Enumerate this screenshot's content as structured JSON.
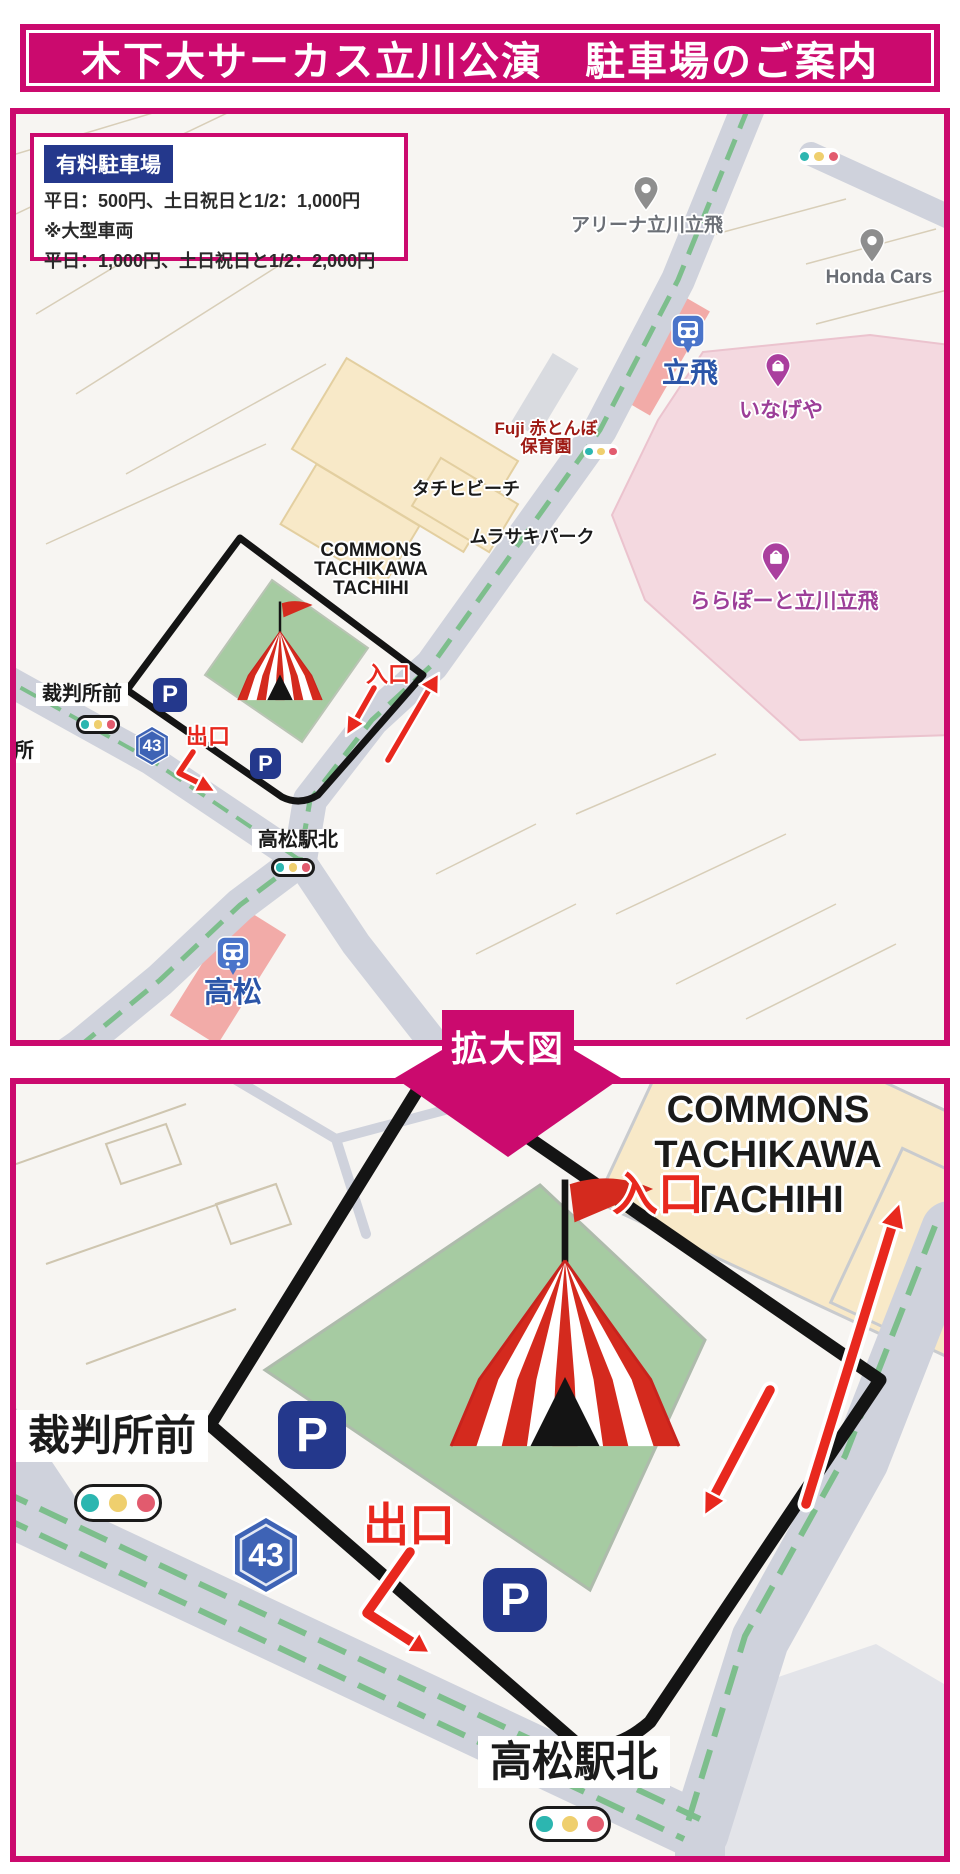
{
  "header": {
    "title": "木下大サーカス立川公演　駐車場のご案内"
  },
  "fee_box": {
    "badge": "有料駐車場",
    "weekday_line": "平日：500円、土日祝日と1/2：1,000円",
    "note": "※大型車両",
    "large_vehicle_line": "平日：1,000円、土日祝日と1/2：2,000円"
  },
  "zoom_badge": {
    "label": "拡大図"
  },
  "common": {
    "parking_icon_label": "P",
    "route_number": "43"
  },
  "map_top": {
    "labels": {
      "arena": "アリーナ立川立飛",
      "honda_cars": "Honda Cars",
      "tachihi_station": "立飛",
      "inageya": "いなげや",
      "nursery_line1": "Fuji 赤とんぼ",
      "nursery_line2": "保育園",
      "tachihi_beach": "タチヒビーチ",
      "murasaki_park": "ムラサキパーク",
      "commons_line1": "COMMONS",
      "commons_line2": "TACHIKAWA",
      "commons_line3": "TACHIHI",
      "lalaport": "ららぽーと立川立飛",
      "saibansho_mae": "裁判所前",
      "saibansho_partial": "所",
      "takamatsu_eki_kita": "高松駅北",
      "takamatsu_station": "高松",
      "entrance": "入口",
      "exit": "出口"
    }
  },
  "map_bottom": {
    "labels": {
      "commons_line1": "COMMONS",
      "commons_line2": "TACHIKAWA",
      "commons_line3": "TACHIHI",
      "saibansho_mae": "裁判所前",
      "takamatsu_eki_kita": "高松駅北",
      "entrance": "入口",
      "exit": "出口"
    }
  },
  "colors": {
    "brand_magenta": "#CB0A6E",
    "navy": "#24388C",
    "map_blue": "#2B55A8",
    "purple": "#9C3E98",
    "dark_red": "#9E1B15",
    "arrow_red": "#E8281E",
    "tent_red": "#D42A1E",
    "green_area": "#A6CBA2",
    "beige_building": "#F8E9C8",
    "pink_building": "#F4D9E0",
    "station_pink": "#F2ABA8",
    "road_grey": "#CFD2DC",
    "signal_teal": "#2CB6B0",
    "signal_yellow": "#EFCF6E",
    "signal_red": "#E25B6E"
  }
}
